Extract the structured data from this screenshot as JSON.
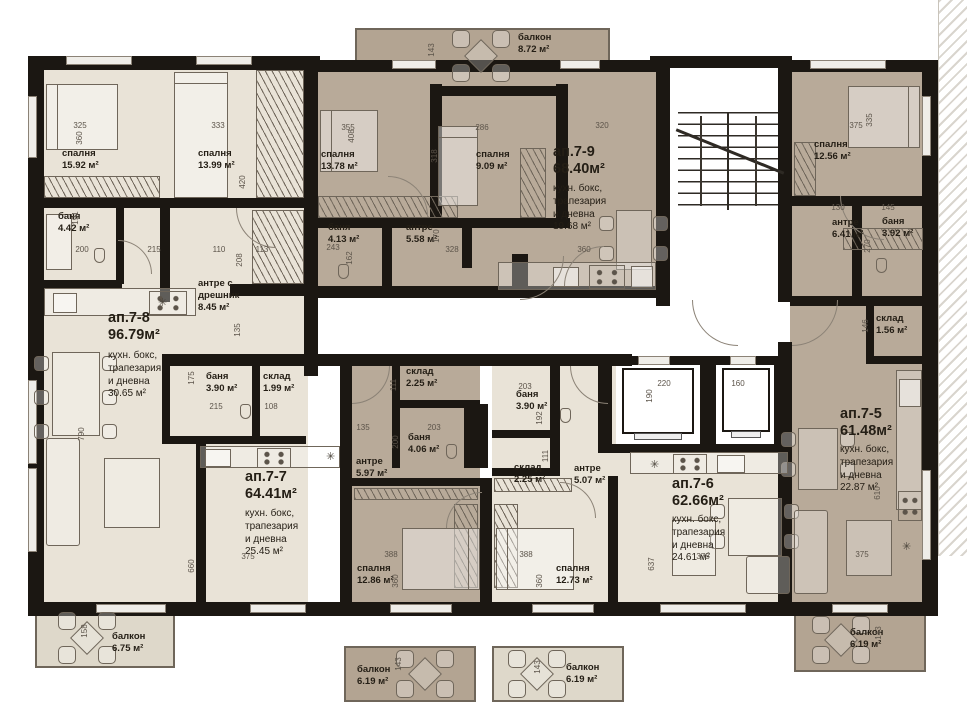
{
  "colors": {
    "wall": "#1b1712",
    "apartment_light": "#e9e3d7",
    "apartment_dark": "#b8aa99",
    "balcony_light": "#ded8ca",
    "balcony_dark": "#b3a492",
    "furniture_line": "#6f665a",
    "dim_text": "#5c544a"
  },
  "apartments": [
    {
      "id": "ап.7-8",
      "total_area": "96.79м²",
      "header_pos": {
        "x": 108,
        "y": 310
      },
      "labels": [
        {
          "name": "kitchen-living-label",
          "text": "кухн. бокс,\nтрапезария\nи дневна\n30.65 м²",
          "x": 108,
          "y": 350,
          "cls": "sub"
        },
        {
          "name": "bedroom-label",
          "text": "спалня\n15.92 м²",
          "x": 62,
          "y": 148,
          "cls": "room"
        },
        {
          "name": "bedroom-label",
          "text": "спалня\n13.99 м²",
          "x": 198,
          "y": 148,
          "cls": "room"
        },
        {
          "name": "bathroom-label",
          "text": "баня\n4.42 м²",
          "x": 58,
          "y": 211,
          "cls": "room"
        },
        {
          "name": "entry-closet-label",
          "text": "антре с\nдрешник\n8.45 м²",
          "x": 198,
          "y": 278,
          "cls": "room"
        },
        {
          "name": "bathroom-label",
          "text": "баня\n3.90 м²",
          "x": 206,
          "y": 371,
          "cls": "room"
        },
        {
          "name": "storage-label",
          "text": "склад\n1.99 м²",
          "x": 263,
          "y": 371,
          "cls": "room"
        },
        {
          "name": "balcony-label",
          "text": "балкон\n6.75 м²",
          "x": 112,
          "y": 631,
          "cls": "room"
        }
      ]
    },
    {
      "id": "ап.7-9",
      "total_area": "68.40м²",
      "header_pos": {
        "x": 553,
        "y": 144
      },
      "labels": [
        {
          "name": "kitchen-living-label",
          "text": "кухн. бокс,\nтрапезария\nи дневна\n19.68 м²",
          "x": 553,
          "y": 183,
          "cls": "sub"
        },
        {
          "name": "balcony-label",
          "text": "балкон\n8.72 м²",
          "x": 518,
          "y": 32,
          "cls": "room"
        },
        {
          "name": "bedroom-label",
          "text": "спалня\n13.78 м²",
          "x": 321,
          "y": 149,
          "cls": "room"
        },
        {
          "name": "bedroom-label",
          "text": "спалня\n9.09 м²",
          "x": 476,
          "y": 149,
          "cls": "room"
        },
        {
          "name": "bathroom-label",
          "text": "баня\n4.13 м²",
          "x": 328,
          "y": 222,
          "cls": "room"
        },
        {
          "name": "hall-label",
          "text": "антре\n5.58 м²",
          "x": 406,
          "y": 222,
          "cls": "room"
        }
      ]
    },
    {
      "id": "ап.7-5",
      "total_area": "61.48м²",
      "header_pos": {
        "x": 840,
        "y": 406
      },
      "labels": [
        {
          "name": "kitchen-living-label",
          "text": "кухн. бокс,\nтрапезария\nи дневна\n22.87 м²",
          "x": 840,
          "y": 444,
          "cls": "sub"
        },
        {
          "name": "bedroom-label",
          "text": "спалня\n12.56 м²",
          "x": 814,
          "y": 139,
          "cls": "room"
        },
        {
          "name": "hall-label",
          "text": "антре\n6.41 м²",
          "x": 832,
          "y": 217,
          "cls": "room"
        },
        {
          "name": "bathroom-label",
          "text": "баня\n3.92 м²",
          "x": 882,
          "y": 216,
          "cls": "room"
        },
        {
          "name": "storage-label",
          "text": "склад\n1.56 м²",
          "x": 876,
          "y": 313,
          "cls": "room"
        },
        {
          "name": "balcony-label",
          "text": "балкон\n6.19 м²",
          "x": 850,
          "y": 627,
          "cls": "room"
        }
      ]
    },
    {
      "id": "ап.7-7",
      "total_area": "64.41м²",
      "header_pos": {
        "x": 245,
        "y": 469
      },
      "labels": [
        {
          "name": "kitchen-living-label",
          "text": "кухн. бокс,\nтрапезария\nи дневна\n25.45 м²",
          "x": 245,
          "y": 508,
          "cls": "sub"
        },
        {
          "name": "hall-label",
          "text": "антре\n5.97 м²",
          "x": 356,
          "y": 456,
          "cls": "room"
        },
        {
          "name": "bathroom-label",
          "text": "баня\n4.06 м²",
          "x": 408,
          "y": 432,
          "cls": "room"
        },
        {
          "name": "storage-label",
          "text": "склад\n2.25 м²",
          "x": 406,
          "y": 366,
          "cls": "room"
        },
        {
          "name": "bedroom-label",
          "text": "спалня\n12.86 м²",
          "x": 357,
          "y": 563,
          "cls": "room"
        },
        {
          "name": "balcony-label",
          "text": "балкон\n6.19 м²",
          "x": 357,
          "y": 664,
          "cls": "room"
        }
      ]
    },
    {
      "id": "ап.7-6",
      "total_area": "62.66м²",
      "header_pos": {
        "x": 672,
        "y": 476
      },
      "labels": [
        {
          "name": "kitchen-living-label",
          "text": "кухн. бокс,\nтрапезария\nи дневна\n24.61 м²",
          "x": 672,
          "y": 514,
          "cls": "sub"
        },
        {
          "name": "hall-label",
          "text": "антре\n5.07 м²",
          "x": 574,
          "y": 463,
          "cls": "room"
        },
        {
          "name": "bathroom-label",
          "text": "баня\n3.90 м²",
          "x": 516,
          "y": 389,
          "cls": "room"
        },
        {
          "name": "storage-label",
          "text": "склад\n2.25 м²",
          "x": 514,
          "y": 462,
          "cls": "room"
        },
        {
          "name": "bedroom-label",
          "text": "спалня\n12.73 м²",
          "x": 556,
          "y": 563,
          "cls": "room"
        },
        {
          "name": "balcony-label",
          "text": "балкон\n6.19 м²",
          "x": 566,
          "y": 662,
          "cls": "room"
        }
      ]
    }
  ],
  "dims": [
    [
      "325",
      80,
      122,
      0
    ],
    [
      "333",
      218,
      122,
      0
    ],
    [
      "355",
      348,
      124,
      0
    ],
    [
      "286",
      482,
      124,
      0
    ],
    [
      "320",
      602,
      122,
      0
    ],
    [
      "375",
      856,
      122,
      0
    ],
    [
      "200",
      82,
      246,
      0
    ],
    [
      "215",
      154,
      246,
      0
    ],
    [
      "110",
      219,
      246,
      0
    ],
    [
      "113",
      262,
      246,
      0
    ],
    [
      "243",
      333,
      244,
      0
    ],
    [
      "328",
      452,
      246,
      0
    ],
    [
      "360",
      584,
      246,
      0
    ],
    [
      "130",
      838,
      204,
      0
    ],
    [
      "145",
      888,
      204,
      0
    ],
    [
      "135",
      363,
      424,
      0
    ],
    [
      "203",
      434,
      424,
      0
    ],
    [
      "203",
      525,
      383,
      0
    ],
    [
      "215",
      216,
      403,
      0
    ],
    [
      "108",
      271,
      403,
      0
    ],
    [
      "388",
      391,
      551,
      0
    ],
    [
      "388",
      526,
      551,
      0
    ],
    [
      "375",
      248,
      553,
      0
    ],
    [
      "375",
      703,
      553,
      0
    ],
    [
      "375",
      862,
      551,
      0
    ],
    [
      "220",
      664,
      380,
      0
    ],
    [
      "160",
      738,
      380,
      0
    ],
    [
      "360",
      80,
      134,
      1
    ],
    [
      "420",
      243,
      178,
      1
    ],
    [
      "408",
      352,
      132,
      1
    ],
    [
      "318",
      435,
      152,
      1
    ],
    [
      "335",
      870,
      116,
      1
    ],
    [
      "143",
      432,
      46,
      1
    ],
    [
      "191",
      76,
      214,
      1
    ],
    [
      "208",
      240,
      256,
      1
    ],
    [
      "162",
      350,
      254,
      1
    ],
    [
      "170",
      437,
      232,
      1
    ],
    [
      "270",
      868,
      242,
      1
    ],
    [
      "146",
      866,
      322,
      1
    ],
    [
      "135",
      238,
      326,
      1
    ],
    [
      "175",
      192,
      374,
      1
    ],
    [
      "111",
      394,
      381,
      1
    ],
    [
      "200",
      396,
      438,
      1
    ],
    [
      "192",
      540,
      414,
      1
    ],
    [
      "111",
      546,
      452,
      1
    ],
    [
      "790",
      82,
      430,
      1
    ],
    [
      "660",
      192,
      562,
      1
    ],
    [
      "360",
      396,
      577,
      1
    ],
    [
      "360",
      540,
      577,
      1
    ],
    [
      "637",
      652,
      560,
      1
    ],
    [
      "610",
      878,
      489,
      1
    ],
    [
      "158",
      85,
      627,
      1
    ],
    [
      "143",
      399,
      660,
      1
    ],
    [
      "143",
      538,
      663,
      1
    ],
    [
      "143",
      879,
      629,
      1
    ],
    [
      "190",
      650,
      392,
      1
    ]
  ]
}
